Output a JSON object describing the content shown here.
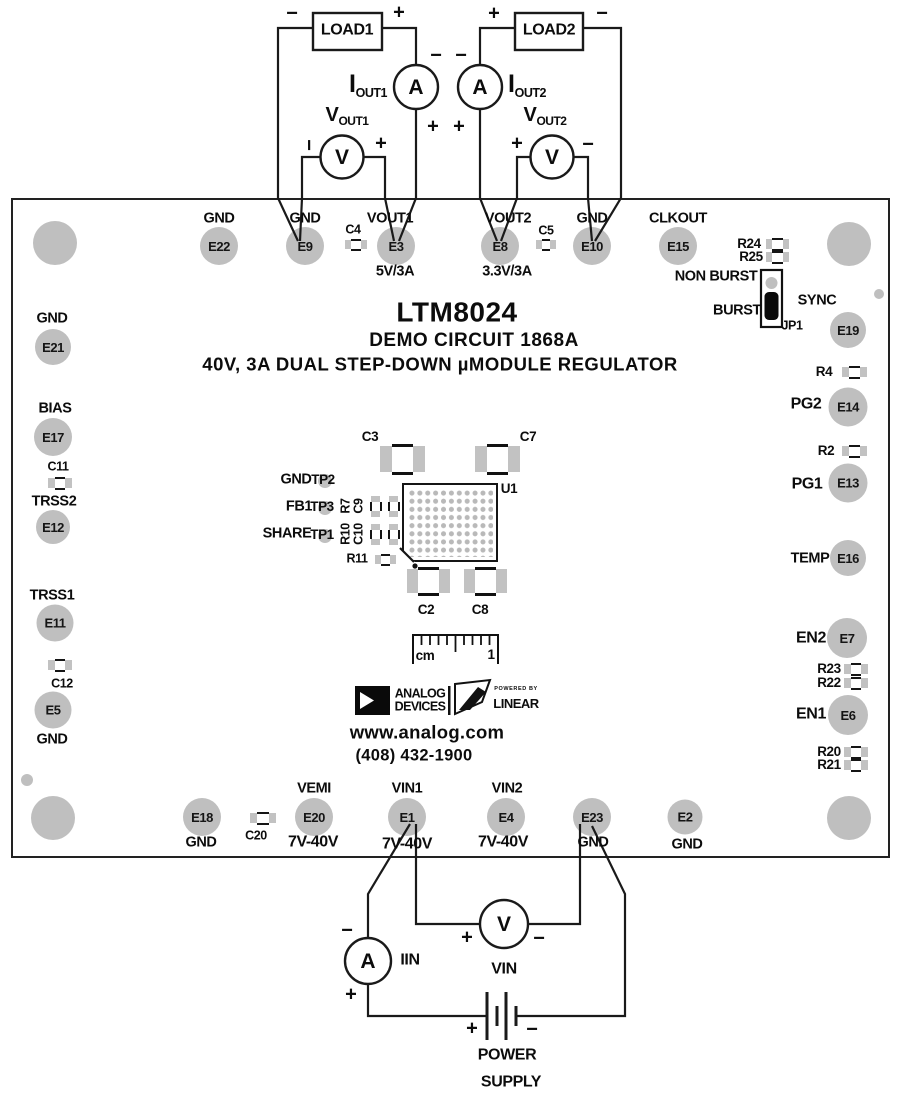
{
  "signs": {
    "plus": "+",
    "minus": "−"
  },
  "meters": {
    "ammeter": "A",
    "voltmeter": "V"
  },
  "top_circuit": {
    "load1": "LOAD1",
    "load2": "LOAD2",
    "iout1": {
      "main": "I",
      "sub": "OUT1"
    },
    "iout2": {
      "main": "I",
      "sub": "OUT2"
    },
    "vout1": {
      "main": "V",
      "sub": "OUT1"
    },
    "vout2": {
      "main": "V",
      "sub": "OUT2"
    }
  },
  "bottom_circuit": {
    "iin": "IIN",
    "vin": "VIN",
    "power_supply": [
      "POWER",
      "SUPPLY"
    ]
  },
  "silkscreen": {
    "title": "LTM8024",
    "subtitle": "DEMO CIRCUIT 1868A",
    "description": "40V, 3A DUAL STEP-DOWN µMODULE REGULATOR",
    "website": "www.analog.com",
    "phone": "(408) 432-1900",
    "u1": "U1",
    "ruler": {
      "unit": "cm",
      "mark": "1"
    },
    "logo": {
      "analog": "ANALOG",
      "devices": "DEVICES",
      "powered_by": "POWERED BY",
      "linear": "LINEAR"
    }
  },
  "jumper": {
    "name": "JP1",
    "top_label": "NON BURST",
    "bottom_label": "BURST"
  },
  "testpoints": [
    {
      "signal": "GND",
      "tp": "TP2"
    },
    {
      "signal": "FB1",
      "tp": "TP3"
    },
    {
      "signal": "SHARE",
      "tp": "TP1"
    }
  ],
  "pads": {
    "top": [
      {
        "id": "E22",
        "label": "GND"
      },
      {
        "id": "E9",
        "label": "GND"
      },
      {
        "id": "E3",
        "label": "VOUT1",
        "rating": "5V/3A"
      },
      {
        "id": "E8",
        "label": "VOUT2",
        "rating": "3.3V/3A"
      },
      {
        "id": "E10",
        "label": "GND"
      },
      {
        "id": "E15",
        "label": "CLKOUT"
      }
    ],
    "left": [
      {
        "id": "E21",
        "label": "GND"
      },
      {
        "id": "E17",
        "label": "BIAS"
      },
      {
        "id": "E12",
        "label": "TRSS2"
      },
      {
        "id": "E11",
        "label": "TRSS1"
      },
      {
        "id": "E5",
        "label": "GND"
      }
    ],
    "right": [
      {
        "id": "E19",
        "label": "SYNC"
      },
      {
        "id": "E14",
        "label": "PG2"
      },
      {
        "id": "E13",
        "label": "PG1"
      },
      {
        "id": "E16",
        "label": "TEMP"
      },
      {
        "id": "E7",
        "label": "EN2"
      },
      {
        "id": "E6",
        "label": "EN1"
      }
    ],
    "bottom": [
      {
        "id": "E18",
        "label": "GND"
      },
      {
        "id": "E20",
        "label": "VEMI",
        "rating": "7V-40V"
      },
      {
        "id": "E1",
        "label": "VIN1",
        "rating": "7V-40V"
      },
      {
        "id": "E4",
        "label": "VIN2",
        "rating": "7V-40V"
      },
      {
        "id": "E23",
        "label": "GND"
      },
      {
        "id": "E2",
        "label": "GND"
      }
    ]
  },
  "components": {
    "c2": "C2",
    "c3": "C3",
    "c4": "C4",
    "c5": "C5",
    "c7": "C7",
    "c8": "C8",
    "c9": "C9",
    "c10": "C10",
    "c11": "C11",
    "c12": "C12",
    "c20": "C20",
    "r2": "R2",
    "r4": "R4",
    "r7": "R7",
    "r10": "R10",
    "r11": "R11",
    "r20": "R20",
    "r21": "R21",
    "r22": "R22",
    "r23": "R23",
    "r24": "R24",
    "r25": "R25"
  }
}
